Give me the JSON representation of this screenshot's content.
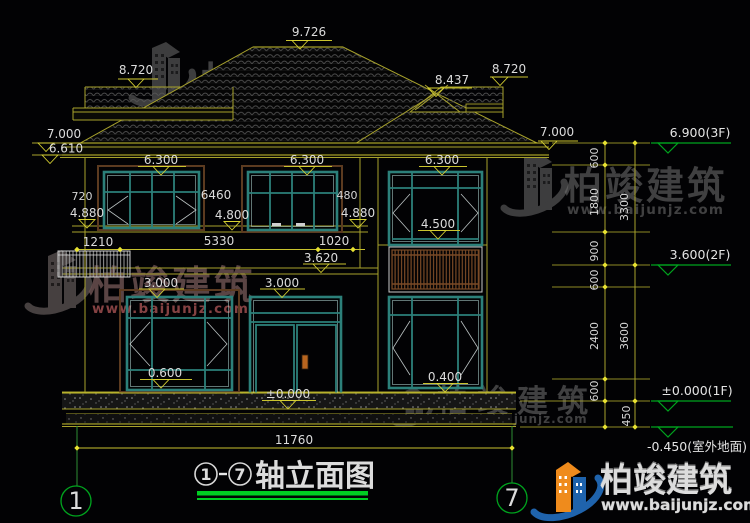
{
  "watermark": {
    "company": "柏竣建筑",
    "url": "www.baijunjz.com"
  },
  "logo": {
    "company": "柏竣建筑",
    "url": "www.baijunjz.com"
  },
  "title": {
    "axis_from": "1",
    "axis_to": "7",
    "label": "轴立面图",
    "full": "①-⑦轴立面图"
  },
  "axes": {
    "left": "1",
    "right": "7"
  },
  "dims": {
    "ridge": "9.726",
    "left_dormer": "8.720",
    "right_dormer_ridge": "8.437",
    "right_dormer": "8.720",
    "eave_left_a": "7.000",
    "eave_left_b": "6.610",
    "eave_right": "7.000",
    "soffit_left": "6.300",
    "soffit_mid": "6.300",
    "soffit_right": "6.300",
    "w720": "720",
    "left_4880": "4.880",
    "w6460": "6460",
    "lvl_4800": "4.800",
    "w480": "480",
    "right_4880": "4.880",
    "lvl_4500": "4.500",
    "w1210": "1210",
    "w5330": "5330",
    "w1020": "1020",
    "lvl_3620": "3.620",
    "lvl_3000_left": "3.000",
    "lvl_3000_right": "3.000",
    "lvl_0600": "0.600",
    "lvl_0000": "±0.000",
    "lvl_0400": "0.400",
    "total_width": "11760"
  },
  "levels_right": {
    "f3": "6.900(3F)",
    "f2": "3.600(2F)",
    "f1": "±0.000(1F)",
    "ground": "-0.450(室外地面)",
    "d600_top": "600",
    "d1800": "1800",
    "d3300": "3300",
    "d900": "900",
    "d600_mid": "600",
    "d2400": "2400",
    "d3600": "3600",
    "d600_low": "600",
    "d450": "450"
  },
  "colors": {
    "line_yellow": "#a8a22b",
    "tick_yellow": "#e8e232",
    "green": "#00a41e",
    "title_underline": "#00cc22",
    "window_teal": "#2c807a",
    "surround_brown": "#5c3b20",
    "rail_brown": "#7a4a26",
    "text": "#dcdcdc",
    "logo_blue": "#1f63ac",
    "logo_orange": "#ef8b1c"
  }
}
